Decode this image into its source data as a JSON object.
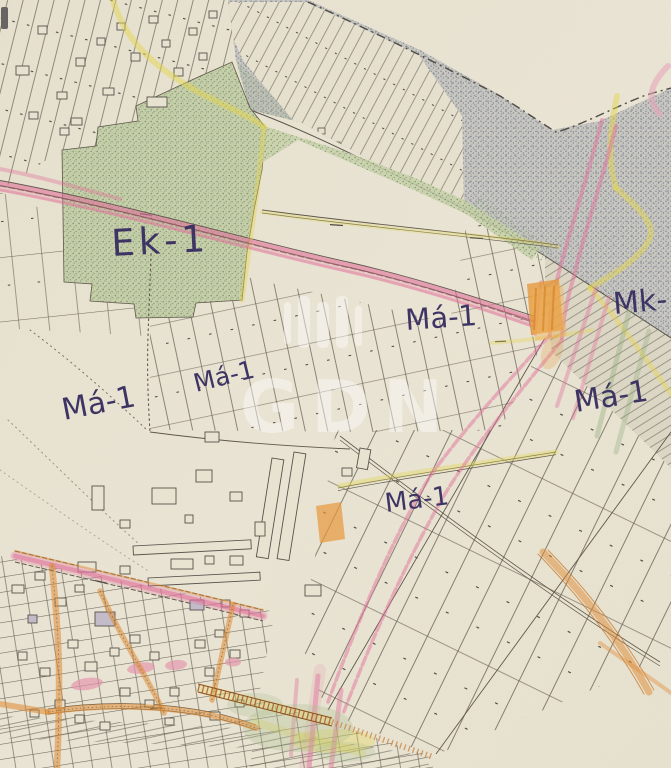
{
  "zone_labels": {
    "ek_1": "Ek-1",
    "ma_1_left": "Má-1",
    "ma_1_center_small": "Má-1",
    "ma_1_center": "Má-1",
    "ma_1_bottom": "Má-1",
    "ma_1_right": "Má-1",
    "mk": "Mk-"
  },
  "watermark": {
    "text": "GDN"
  },
  "palette": {
    "paper": "#e9e3d2",
    "stipple_area": "#a9abb2",
    "green_zone": "#8fae7e",
    "road_pink": "#e2719b",
    "road_yellow": "#e6d74f",
    "road_orange": "#e8993a",
    "railway_brown": "#a85427",
    "map_ink": "#5d564a",
    "handwriting_ink": "#3b3263",
    "watermark_white": "#ffffff"
  }
}
